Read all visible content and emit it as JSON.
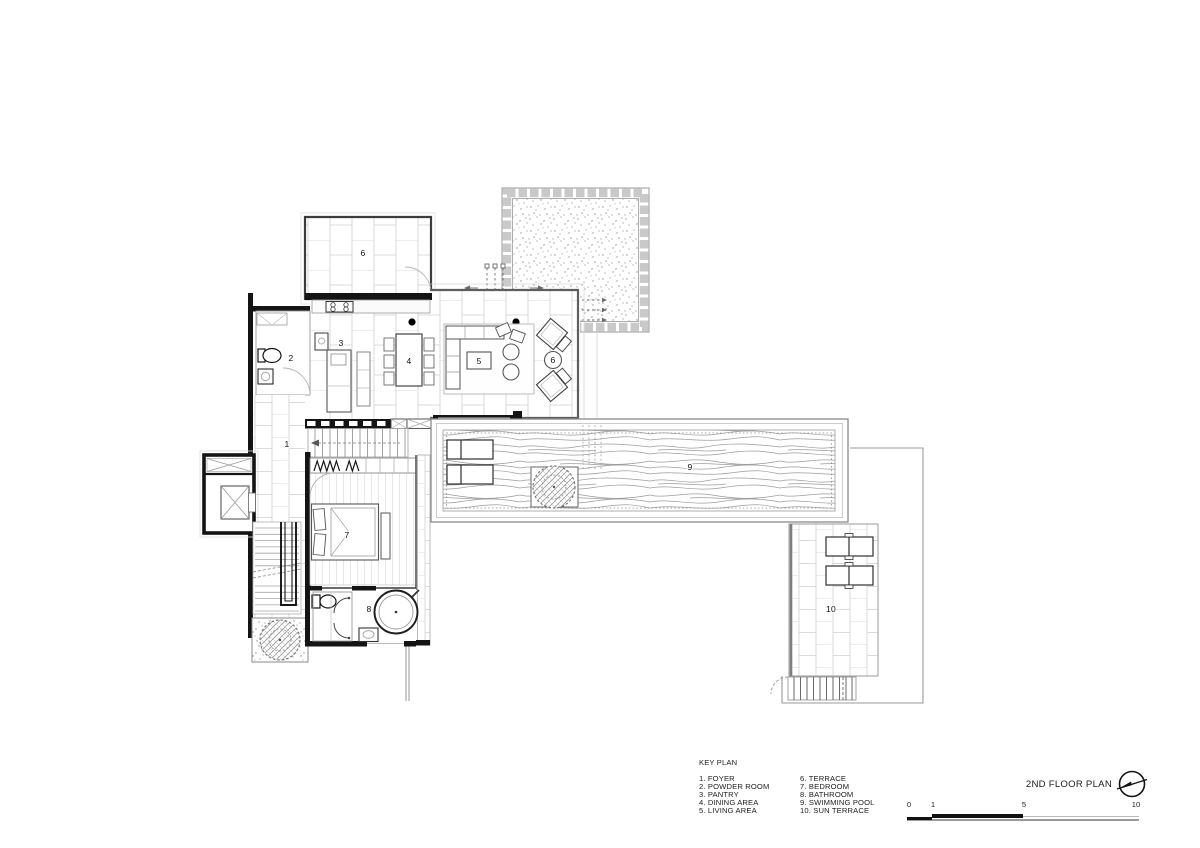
{
  "key_plan": {
    "heading": "KEY PLAN",
    "column1": [
      "1. FOYER",
      "2. POWDER ROOM",
      "3. PANTRY",
      "4. DINING AREA",
      "5. LIVING AREA"
    ],
    "column2": [
      "6. TERRACE",
      "7. BEDROOM",
      "8. BATHROOM",
      "9. SWIMMING POOL",
      "10. SUN TERRACE"
    ]
  },
  "title_block": {
    "title": "2ND FLOOR PLAN",
    "north_icon": "north-arrow",
    "scale_ticks": [
      "0",
      "1",
      "5",
      "10"
    ]
  },
  "plan": {
    "rooms": {
      "foyer": "1",
      "powder_room": "2",
      "pantry": "3",
      "dining_area": "4",
      "living_area": "5",
      "terrace_upper": "6",
      "terrace_side": "6",
      "bedroom": "7",
      "bathroom": "8",
      "swimming_pool": "9",
      "sun_terrace": "10"
    },
    "colors": {
      "wall": "#141414",
      "line_dark": "#3c3c3c",
      "line_mid": "#8c8c8c",
      "line_light": "#cccccc",
      "water_line": "#9c9c9c"
    }
  }
}
